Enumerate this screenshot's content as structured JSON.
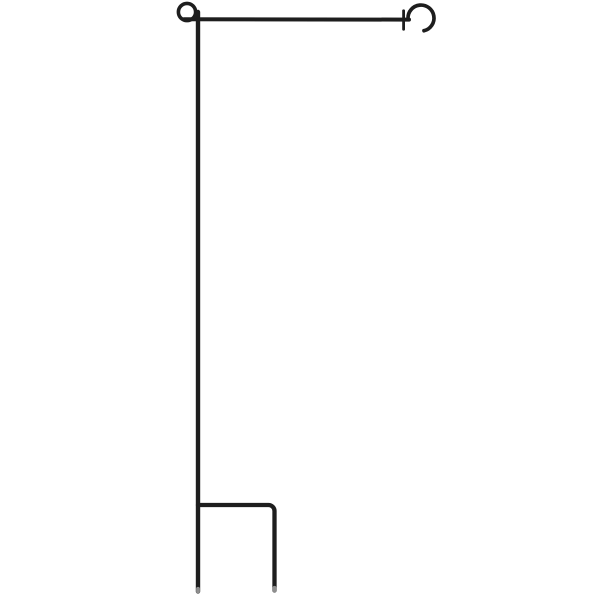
{
  "image": {
    "description": "Product photo of a black wrought-iron garden flag stand on a plain white background",
    "background_color": "#ffffff"
  },
  "stand": {
    "wire_color": "#1e1e1e",
    "stake_tip_color": "#8f8f8f",
    "parts": {
      "top_loop": "decorative loop joint at top of pole",
      "hanger_arm": "horizontal flag hanger arm",
      "stopper_clip": "small anti-slip flag stopper clip on hanger arm",
      "end_hook": "curled retaining hook at end of hanger arm",
      "pole": "vertical main pole",
      "step_bar_right_stake": "step cross bar bending down into right ground stake prong",
      "left_stake_tip": "left ground stake tip",
      "right_stake_tip": "right ground stake tip"
    }
  }
}
